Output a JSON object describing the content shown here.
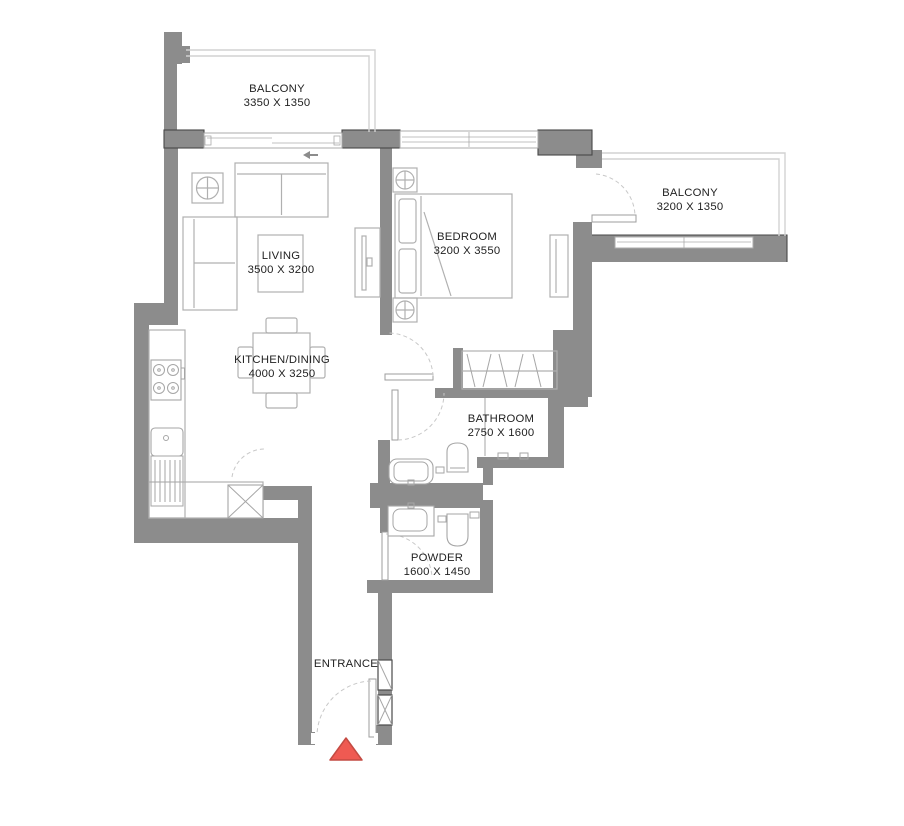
{
  "plan": {
    "rooms": [
      {
        "id": "balcony-top",
        "name": "BALCONY",
        "dims": "3350 X 1350"
      },
      {
        "id": "balcony-right",
        "name": "BALCONY",
        "dims": "3200 X 1350"
      },
      {
        "id": "living",
        "name": "LIVING",
        "dims": "3500 X 3200"
      },
      {
        "id": "bedroom",
        "name": "BEDROOM",
        "dims": "3200 X 3550"
      },
      {
        "id": "kitchen-dining",
        "name": "KITCHEN/DINING",
        "dims": "4000 X 3250"
      },
      {
        "id": "bathroom",
        "name": "BATHROOM",
        "dims": "2750 X 1600"
      },
      {
        "id": "powder",
        "name": "POWDER",
        "dims": "1600 X 1450"
      },
      {
        "id": "entrance",
        "name": "ENTRANCE",
        "dims": ""
      }
    ],
    "colors": {
      "background": "#ffffff",
      "wall": "#8c8c8c",
      "outline": "#474747",
      "railing": "#d2d2d2",
      "winframe": "#ababab",
      "furniture": "#b0b0b0",
      "fixture": "#a6a6a6",
      "doorarc": "#c8c8c8",
      "shaftline": "#4a4a4a",
      "text": "#222222",
      "marker": "#ef5a52",
      "markerborder": "#c44b43"
    }
  }
}
